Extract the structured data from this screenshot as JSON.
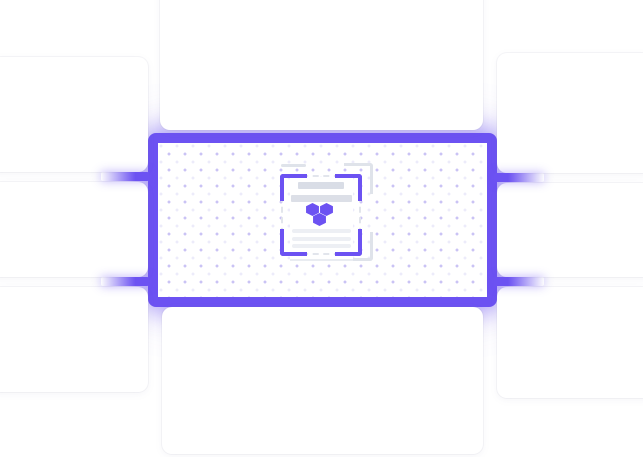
{
  "illustration": {
    "kind": "integration-diagram",
    "colors": {
      "accent": "#6C52F2",
      "accent_glow": "rgba(108,82,242,0.50)",
      "card_bg": "#ffffff",
      "dot_grid": "#cbc4ee",
      "bar_gray": "#d9dde6",
      "bar_gray_wide": "#dcdfe7",
      "text_line_gray": "#edeff4",
      "bracket_gray": "#dfe3ea"
    },
    "center_node": {
      "icon": "document-scan-icon",
      "hexagon_count": 3,
      "text_bar_count": 2,
      "text_line_count": 3
    },
    "cards": {
      "left_count": 3,
      "right_count": 3,
      "top_count": 1,
      "bottom_count": 1
    },
    "connectors": {
      "count": 4,
      "sides": [
        "left",
        "left",
        "right",
        "right"
      ]
    }
  }
}
